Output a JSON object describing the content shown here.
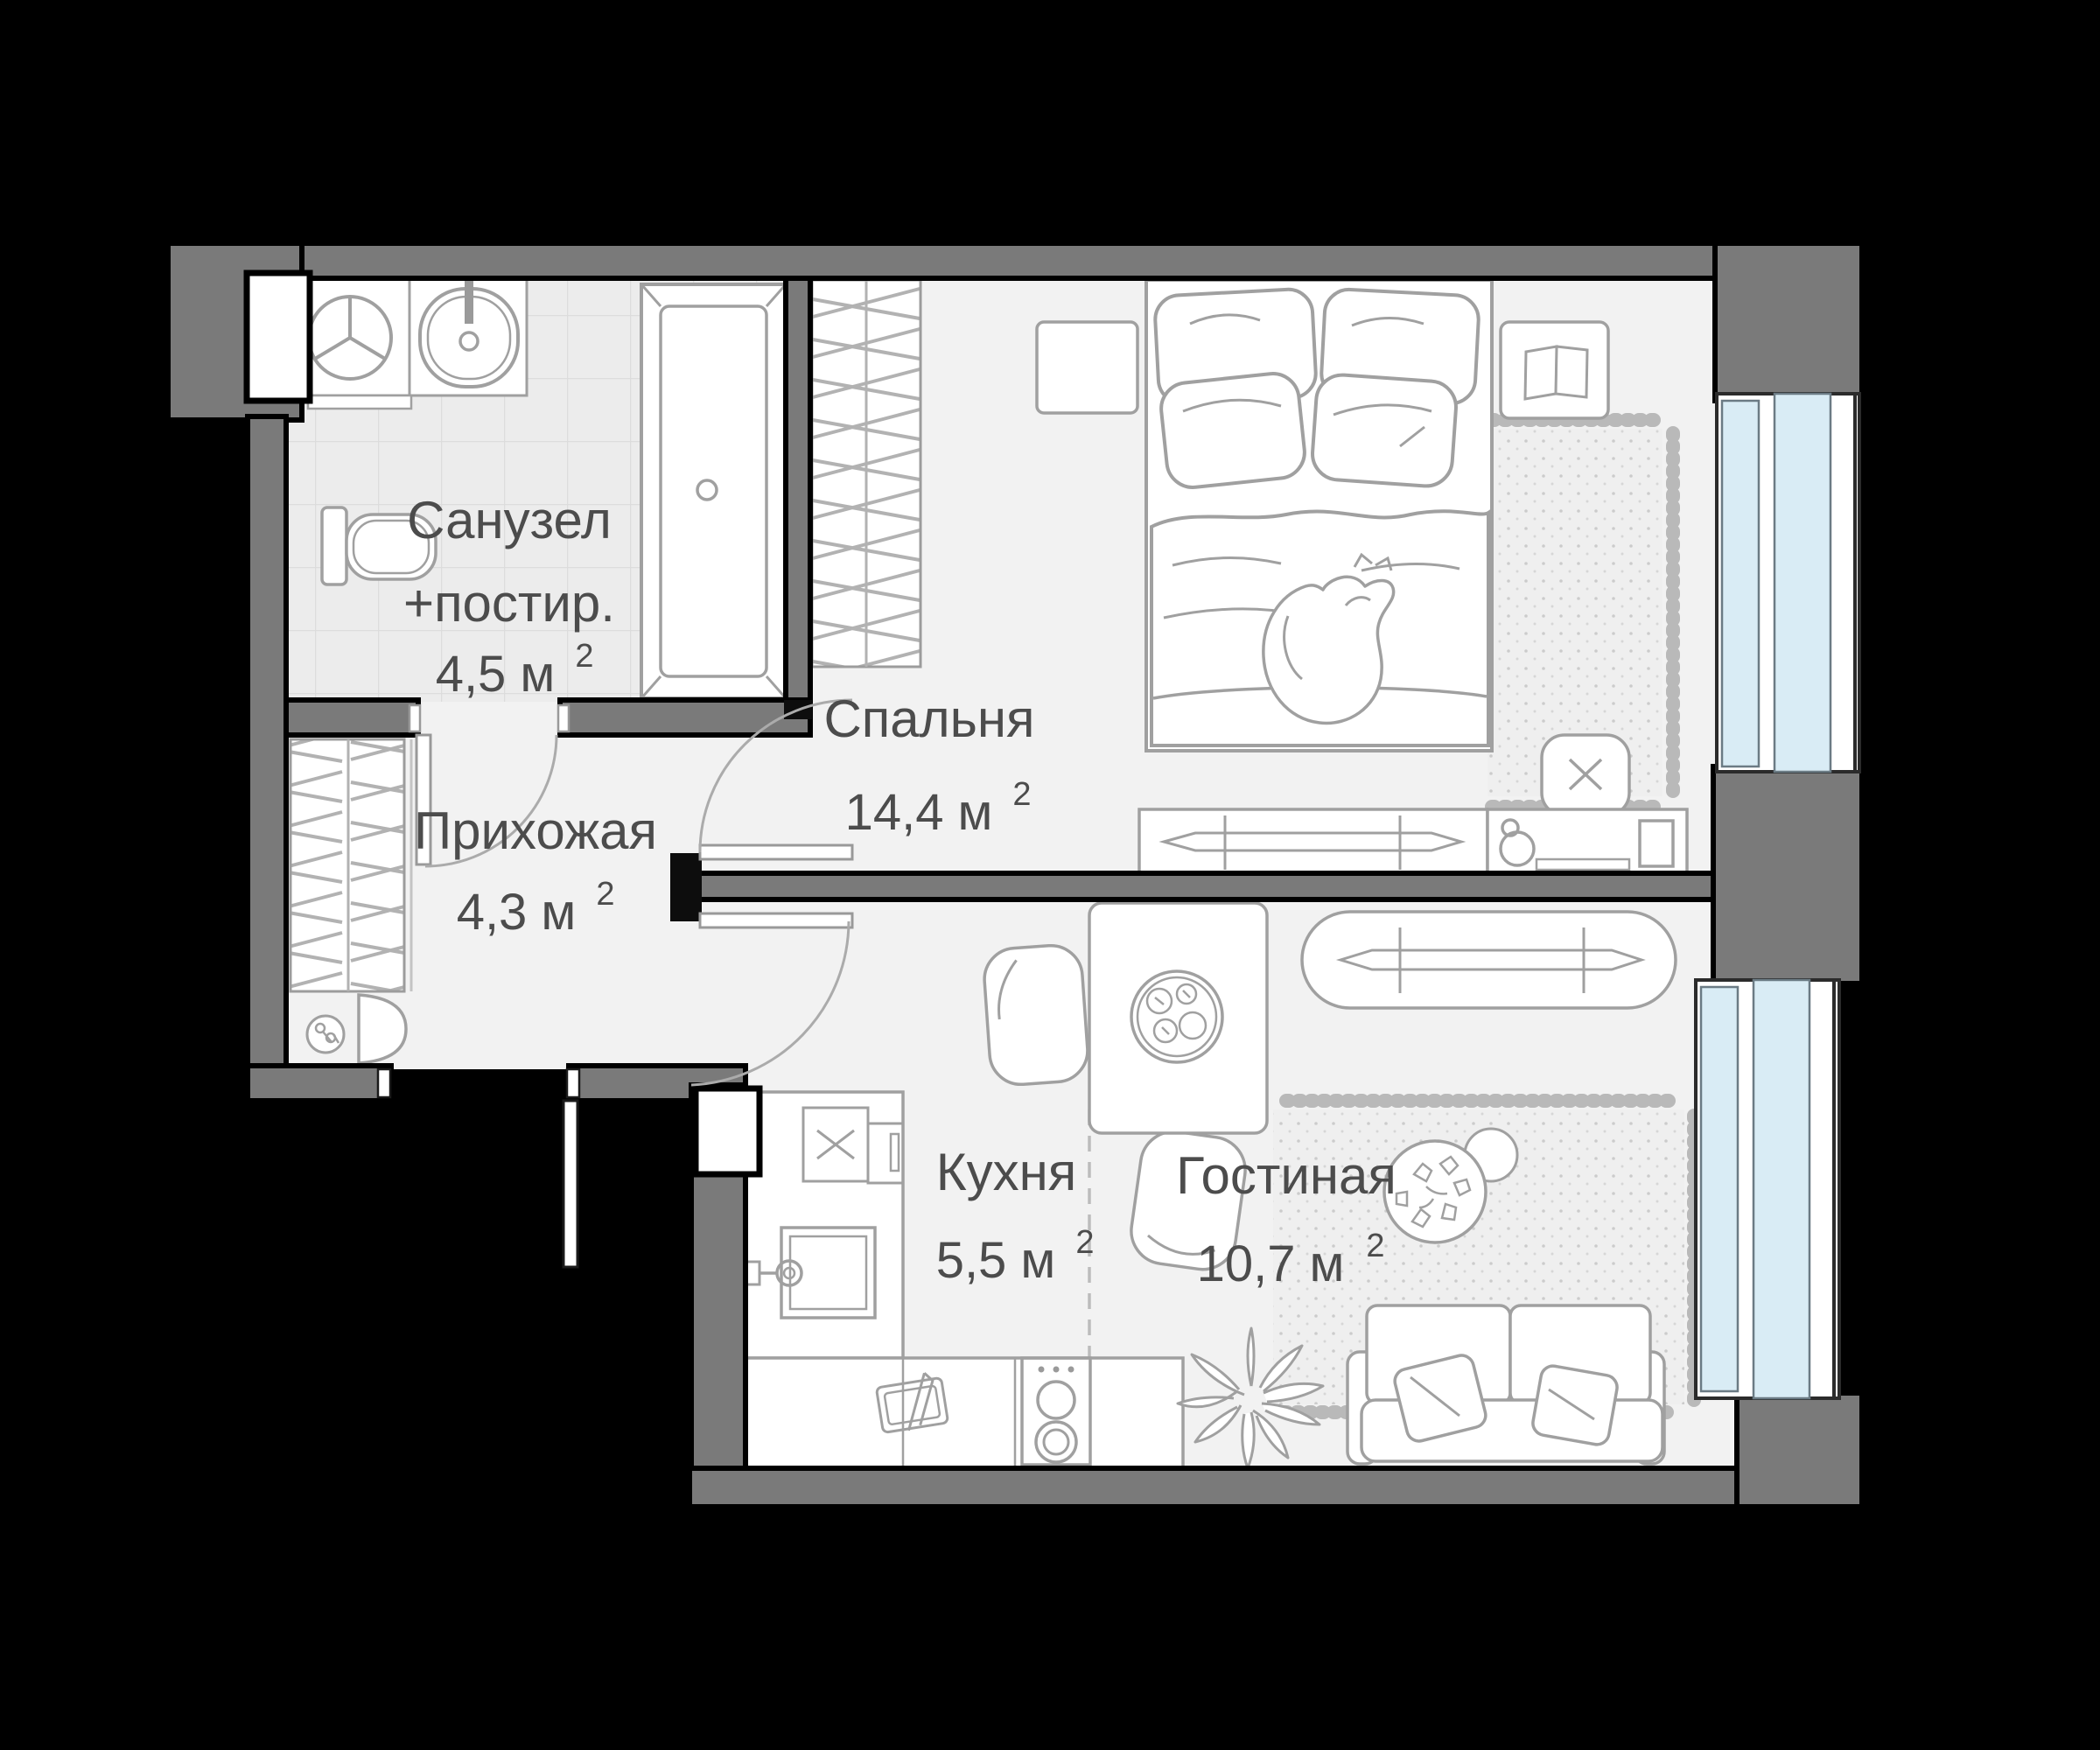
{
  "plan": {
    "type": "apartment-floor-plan",
    "background_color": "#000000",
    "wall_color": "#7a7a7a",
    "wall_outline_color": "#000000",
    "floor_color": "#f2f2f2",
    "tile_color": "#ececec",
    "furniture_stroke_color": "#a0a0a0",
    "glass_color": "#d9ecf5",
    "rooms": [
      {
        "id": "bathroom",
        "name_line1": "Санузел",
        "name_line2": "+постир.",
        "area_main": "4,5 м",
        "area_sup": "2"
      },
      {
        "id": "bedroom",
        "name": "Спальня",
        "area_main": "14,4 м",
        "area_sup": "2"
      },
      {
        "id": "hallway",
        "name": "Прихожая",
        "area_main": "4,3 м",
        "area_sup": "2"
      },
      {
        "id": "kitchen",
        "name": "Кухня",
        "area_main": "5,5 м",
        "area_sup": "2"
      },
      {
        "id": "living",
        "name": "Гостиная",
        "area_main": "10,7 м",
        "area_sup": "2"
      }
    ],
    "furniture_icons": [
      "washing-machine-icon",
      "bathroom-sink-icon",
      "bathtub-icon",
      "toilet-icon",
      "wardrobe-icon",
      "hall-closet-icon",
      "console-table-icon",
      "keys-icon",
      "entry-door-icon",
      "bathroom-door-icon",
      "bedroom-door-icon",
      "living-door-icon",
      "bed-icon",
      "pillow-icon",
      "cat-icon",
      "nightstand-icon",
      "book-icon",
      "rug-icon",
      "dresser-icon",
      "desk-icon",
      "desk-chair-icon",
      "monitor-icon",
      "desk-lamp-icon",
      "tv-console-icon",
      "dining-table-icon",
      "plate-icon",
      "dining-chair-icon",
      "kitchen-counter-icon",
      "kitchen-sink-icon",
      "fridge-icon",
      "tall-cabinet-icon",
      "stove-icon",
      "cutting-board-icon",
      "sofa-icon",
      "coffee-table-icon",
      "flowers-icon",
      "plant-icon",
      "window-icon",
      "shaft-icon"
    ]
  }
}
